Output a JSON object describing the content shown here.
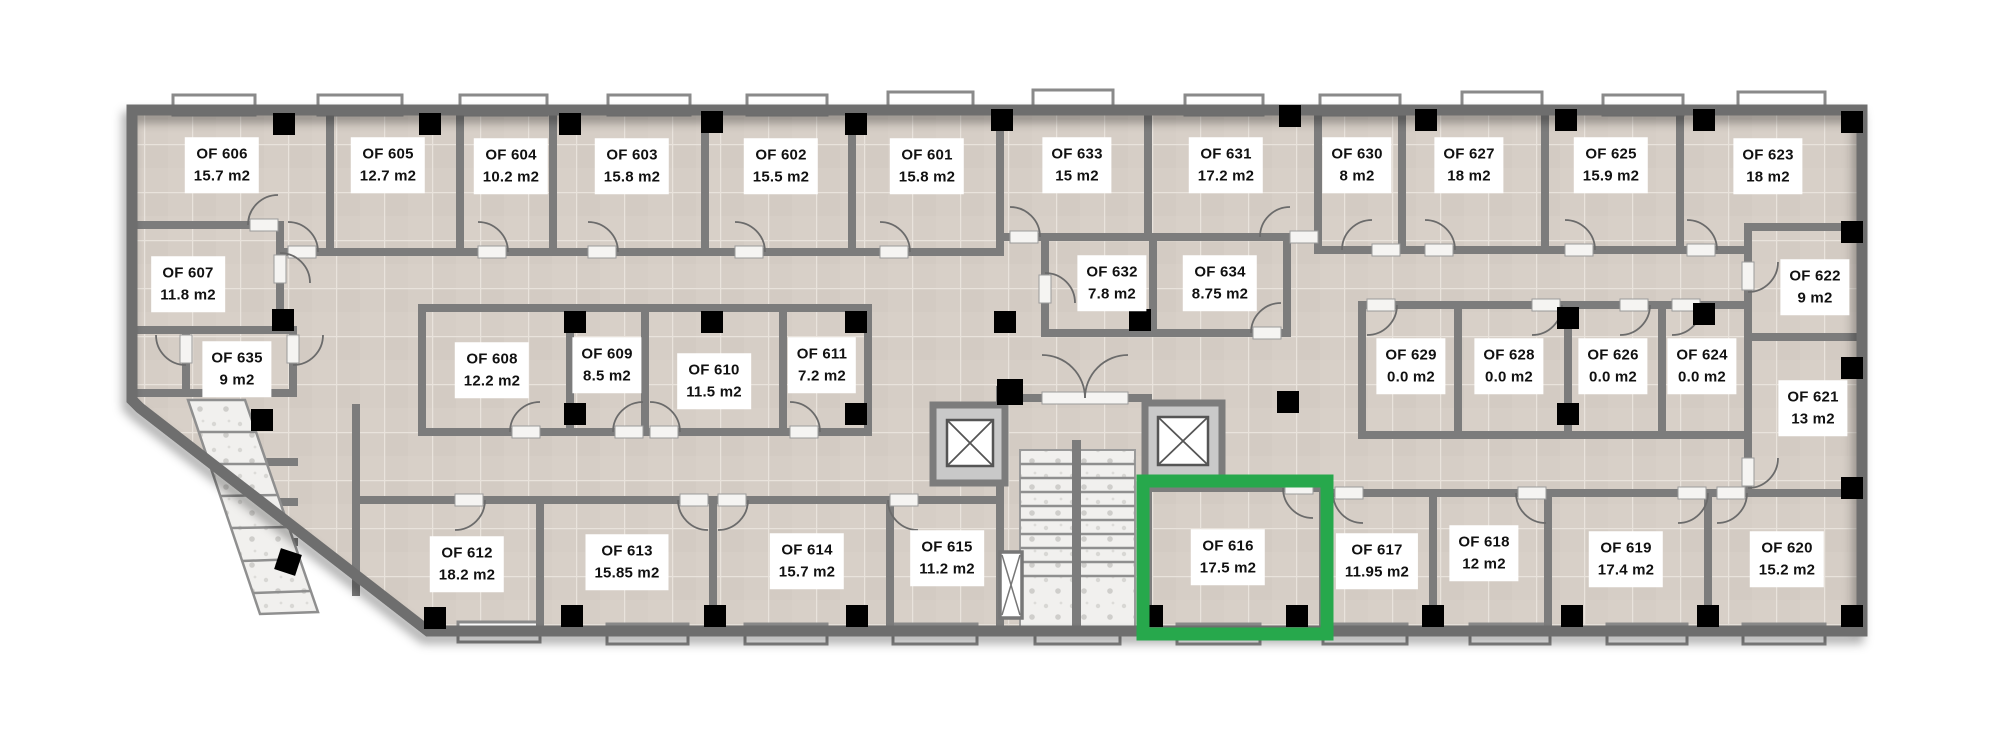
{
  "floor_plan": {
    "selected_room_id": "OF 616",
    "highlight_color": "#27A84C",
    "rooms": [
      {
        "id": "OF 601",
        "area": "15.8 m2"
      },
      {
        "id": "OF 602",
        "area": "15.5 m2"
      },
      {
        "id": "OF 603",
        "area": "15.8 m2"
      },
      {
        "id": "OF 604",
        "area": "10.2 m2"
      },
      {
        "id": "OF 605",
        "area": "12.7 m2"
      },
      {
        "id": "OF 606",
        "area": "15.7 m2"
      },
      {
        "id": "OF 607",
        "area": "11.8 m2"
      },
      {
        "id": "OF 608",
        "area": "12.2 m2"
      },
      {
        "id": "OF 609",
        "area": "8.5 m2"
      },
      {
        "id": "OF 610",
        "area": "11.5 m2"
      },
      {
        "id": "OF 611",
        "area": "7.2 m2"
      },
      {
        "id": "OF 612",
        "area": "18.2 m2"
      },
      {
        "id": "OF 613",
        "area": "15.85 m2"
      },
      {
        "id": "OF 614",
        "area": "15.7 m2"
      },
      {
        "id": "OF 615",
        "area": "11.2 m2"
      },
      {
        "id": "OF 616",
        "area": "17.5 m2"
      },
      {
        "id": "OF 617",
        "area": "11.95 m2"
      },
      {
        "id": "OF 618",
        "area": "12 m2"
      },
      {
        "id": "OF 619",
        "area": "17.4 m2"
      },
      {
        "id": "OF 620",
        "area": "15.2 m2"
      },
      {
        "id": "OF 621",
        "area": "13 m2"
      },
      {
        "id": "OF 622",
        "area": "9 m2"
      },
      {
        "id": "OF 623",
        "area": "18 m2"
      },
      {
        "id": "OF 624",
        "area": "0.0 m2"
      },
      {
        "id": "OF 625",
        "area": "15.9 m2"
      },
      {
        "id": "OF 626",
        "area": "0.0 m2"
      },
      {
        "id": "OF 627",
        "area": "18 m2"
      },
      {
        "id": "OF 628",
        "area": "0.0 m2"
      },
      {
        "id": "OF 629",
        "area": "0.0 m2"
      },
      {
        "id": "OF 630",
        "area": "8 m2"
      },
      {
        "id": "OF 631",
        "area": "17.2 m2"
      },
      {
        "id": "OF 632",
        "area": "7.8 m2"
      },
      {
        "id": "OF 633",
        "area": "15 m2"
      },
      {
        "id": "OF 634",
        "area": "8.75 m2"
      },
      {
        "id": "OF 635",
        "area": "9 m2"
      }
    ]
  }
}
